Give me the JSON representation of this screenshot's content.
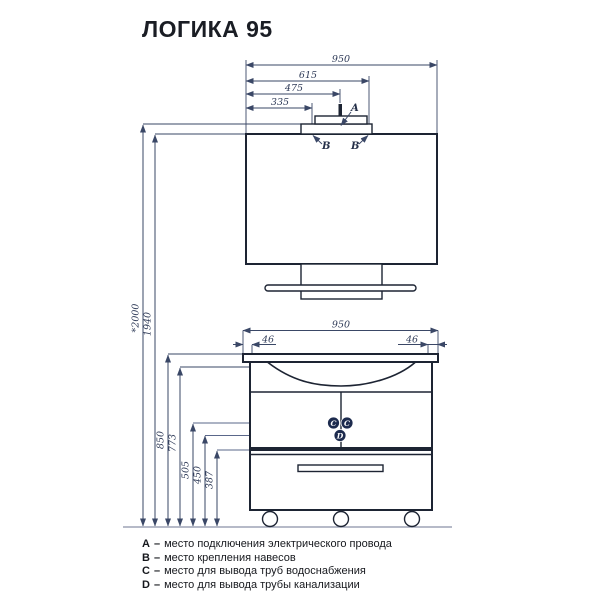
{
  "title": "ЛОГИКА 95",
  "colors": {
    "ink": "#1d2433",
    "dim_line": "#3a4766",
    "marker_fill": "#1d2b4e"
  },
  "markers": {
    "a": "A",
    "b": "B",
    "c": "C",
    "d": "D"
  },
  "mirror_unit": {
    "width": "950",
    "hanger_right": "615",
    "power_center": "475",
    "hanger_left": "335"
  },
  "heights": {
    "total": "*2000",
    "mirror_top": "1940",
    "countertop": "850",
    "hanger": "773",
    "water_supply": "505",
    "drain": "450",
    "drawer_top": "387"
  },
  "vanity_unit": {
    "width": "950",
    "hanger_offset_left": "46",
    "hanger_offset_right": "46"
  },
  "legend": [
    {
      "key": "A",
      "sep": "–",
      "text": "место подключения электрического провода"
    },
    {
      "key": "B",
      "sep": "–",
      "text": "место крепления навесов"
    },
    {
      "key": "C",
      "sep": "–",
      "text": "место для вывода труб водоснабжения"
    },
    {
      "key": "D",
      "sep": "–",
      "text": "место для вывода трубы канализации"
    }
  ]
}
